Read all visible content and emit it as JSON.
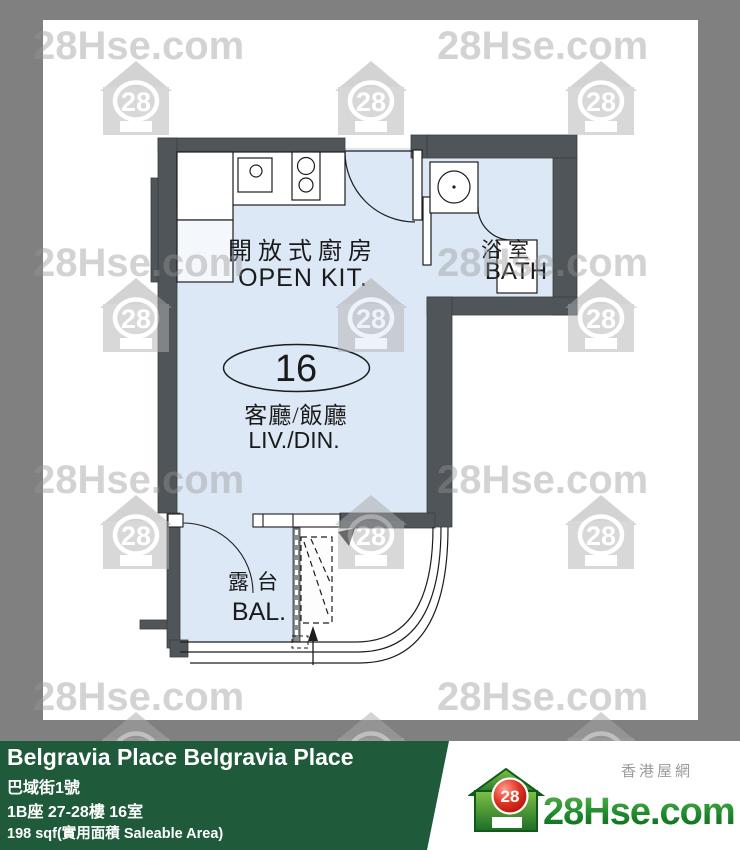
{
  "colors": {
    "frame_gray": "#808080",
    "footer_green": "#1f5b3a",
    "wall": "#50555a",
    "floor": "#dce8f5",
    "watermark_gray": "#969696"
  },
  "watermark": {
    "text": "28Hse.com",
    "badge": "28",
    "text_positions": [
      [
        33,
        26
      ],
      [
        437,
        26
      ],
      [
        33,
        243
      ],
      [
        437,
        243
      ],
      [
        33,
        460
      ],
      [
        437,
        460
      ],
      [
        33,
        677
      ],
      [
        437,
        677
      ]
    ],
    "icon_positions": [
      [
        100,
        61
      ],
      [
        335,
        61
      ],
      [
        565,
        61
      ],
      [
        100,
        278
      ],
      [
        335,
        278
      ],
      [
        565,
        278
      ],
      [
        100,
        495
      ],
      [
        335,
        495
      ],
      [
        565,
        495
      ],
      [
        100,
        712
      ],
      [
        335,
        712
      ],
      [
        565,
        712
      ]
    ]
  },
  "plan": {
    "unit_number": "16",
    "rooms": {
      "kitchen": {
        "zh": "開放式廚房",
        "en": "OPEN KIT."
      },
      "bath": {
        "zh": "浴室",
        "en": "BATH"
      },
      "living": {
        "zh": "客廳/飯廳",
        "en": "LIV./DIN."
      },
      "balcony": {
        "zh": "露台",
        "en": "BAL."
      }
    }
  },
  "footer": {
    "title": "Belgravia Place Belgravia Place",
    "address": "巴域街1號",
    "unit": "1B座 27-28樓 16室",
    "area": "198 sqf(實用面積 Saleable Area)"
  },
  "logo": {
    "site": "28Hse.com",
    "badge": "28",
    "tagline": "香港屋網"
  }
}
